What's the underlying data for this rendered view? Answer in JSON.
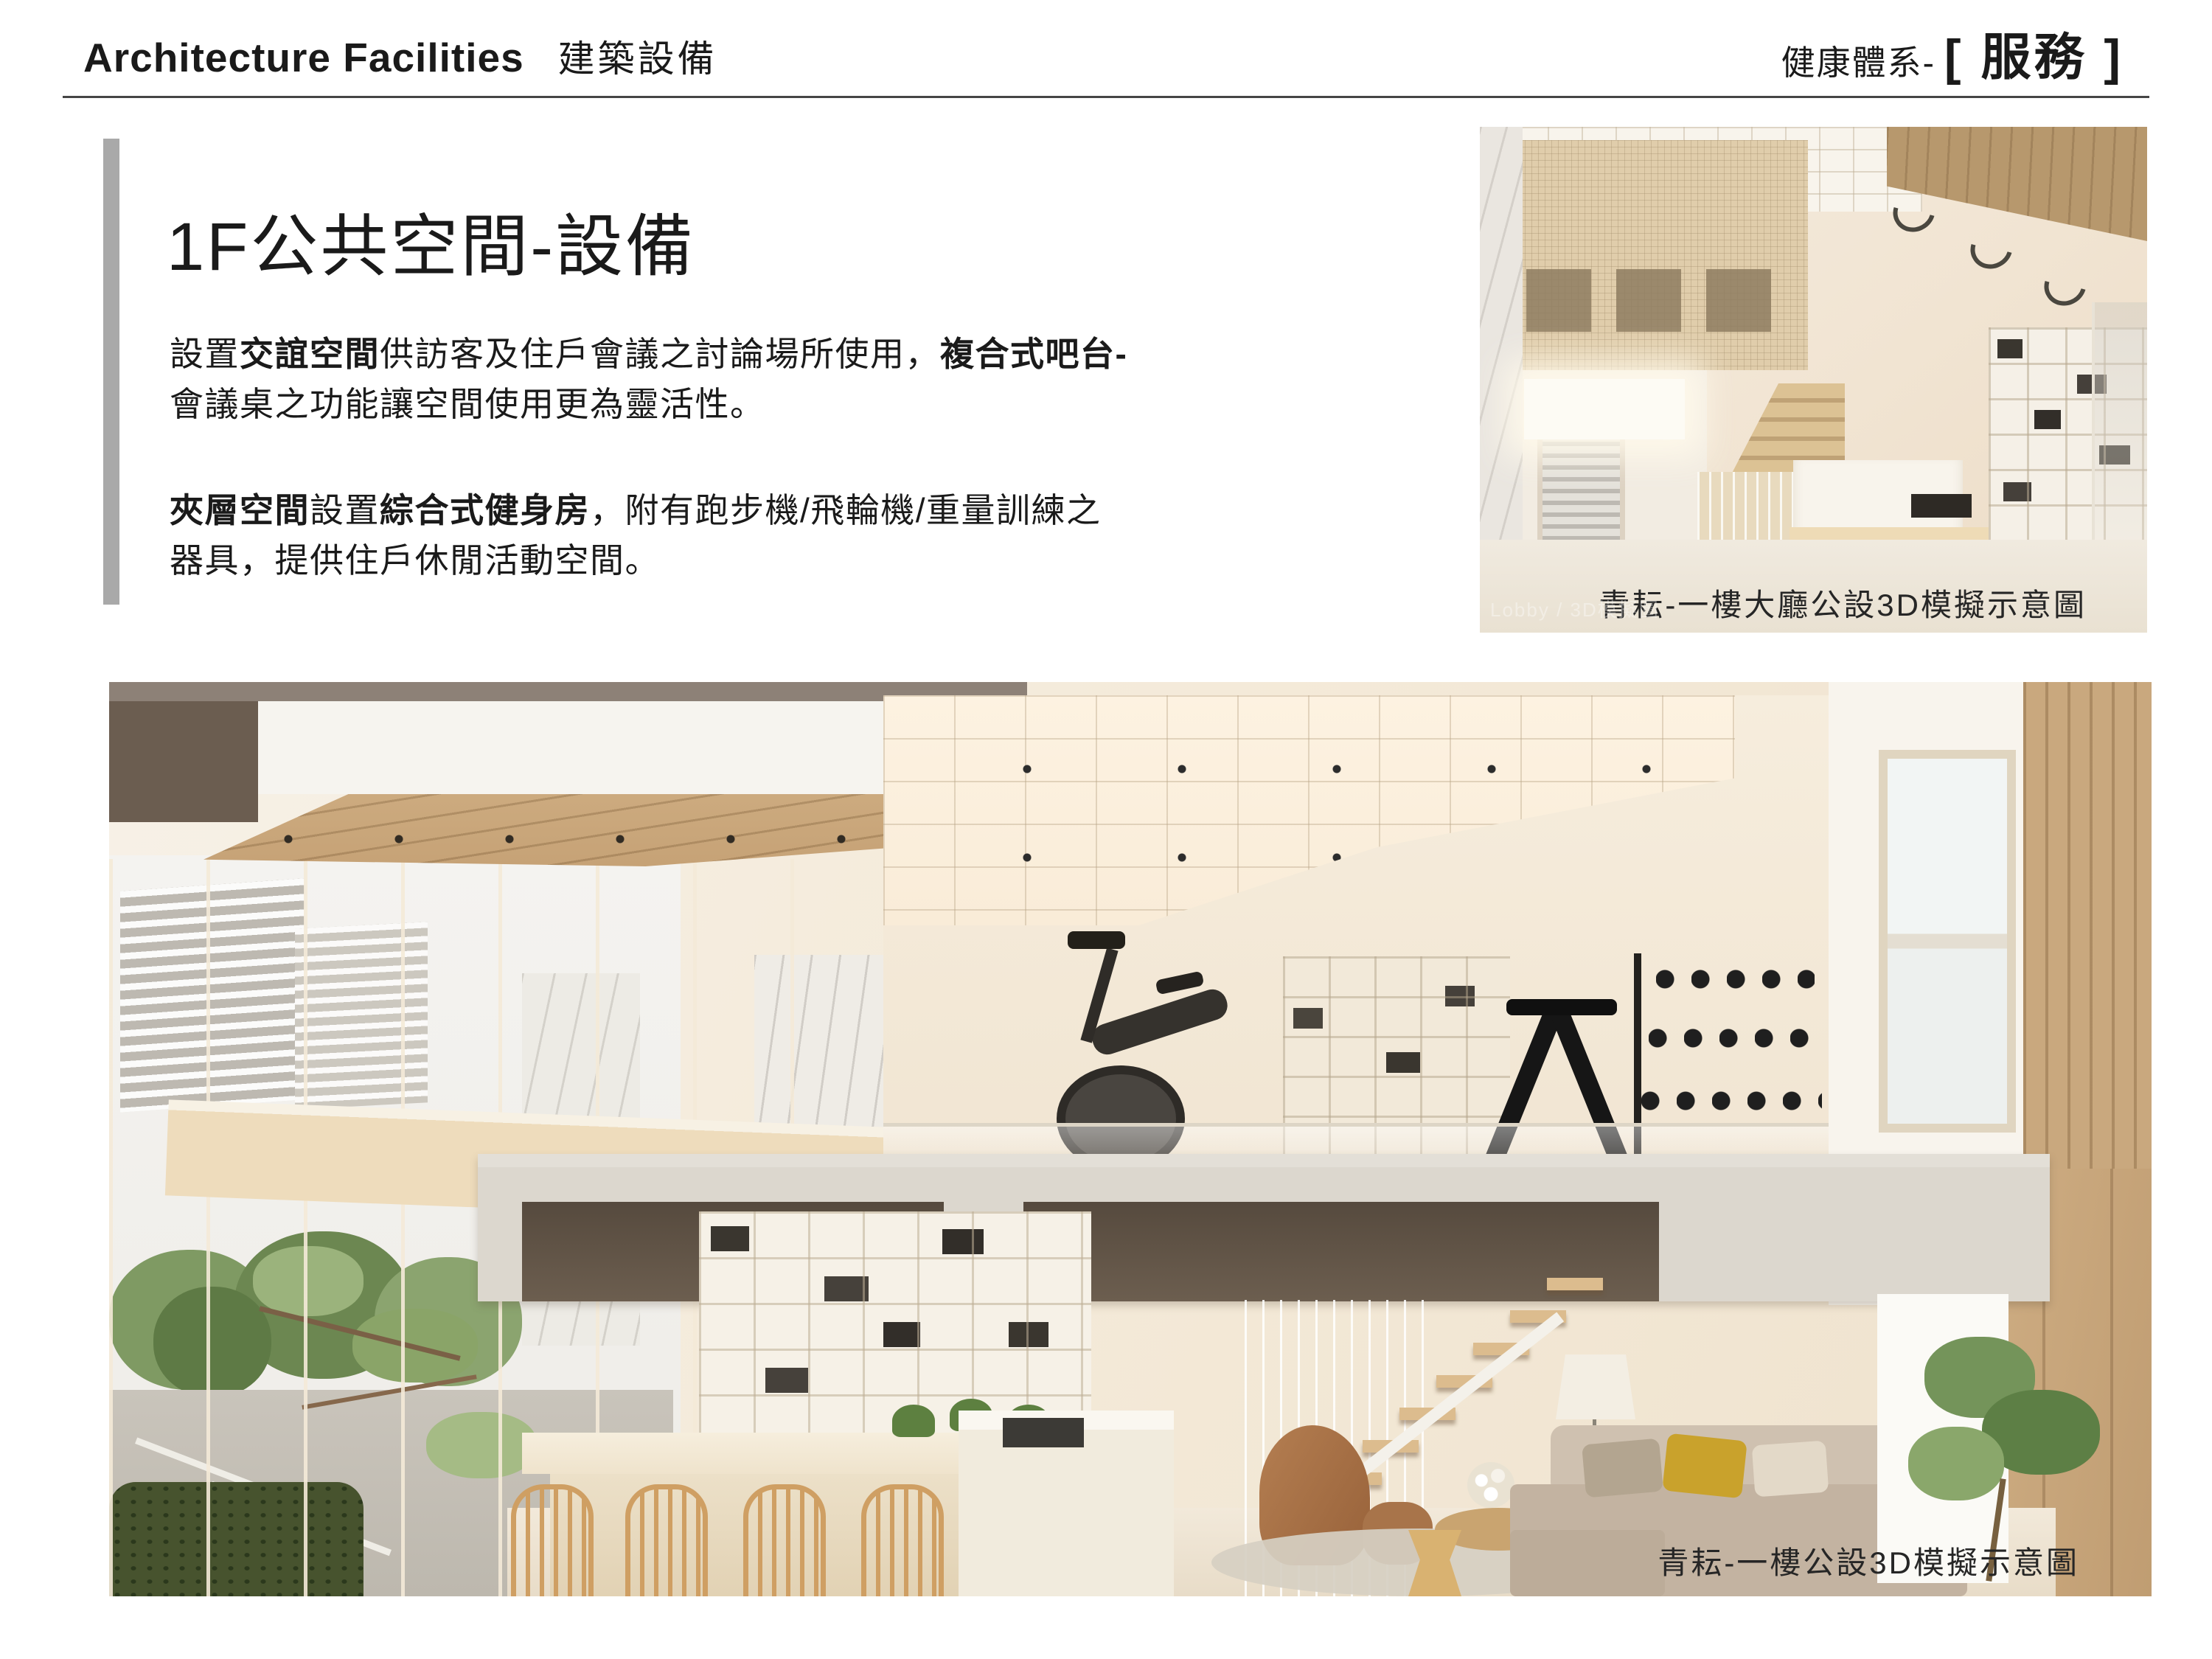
{
  "header": {
    "title_en": "Architecture Facilities",
    "title_zh": "建築設備",
    "right_label": "健康體系-",
    "right_tag": "[ 服務 ]"
  },
  "content": {
    "section_title": "1F公共空間-設備",
    "p1": {
      "r1": "設置",
      "r2": "交誼空間",
      "r3": "供訪客及住戶會議之討論場所使用，",
      "r4": "複合式吧台-",
      "r5": "會議桌之功能讓空間使用更為靈活性。"
    },
    "p2": {
      "r1": "夾層空間",
      "r2": "設置",
      "r3": "綜合式健身房",
      "r4": "，附有跑步機/飛輪機/重量訓練之",
      "r5": "器具，提供住戶休閒活動空間。"
    }
  },
  "lobby_image": {
    "caption": "青耘-一樓大廳公設3D模擬示意圖",
    "watermark": "Lobby / 3D模擬圖"
  },
  "main_image": {
    "caption": "青耘-一樓公設3D模擬示意圖"
  },
  "colors": {
    "text": "#1a1a1a",
    "accent_bar": "#a9a9a9",
    "divider": "#454545",
    "caption": "#262626",
    "render_cream": "#f2e7d8",
    "render_wood": "#c9a87e",
    "render_dark_beam": "#6b5d50"
  }
}
